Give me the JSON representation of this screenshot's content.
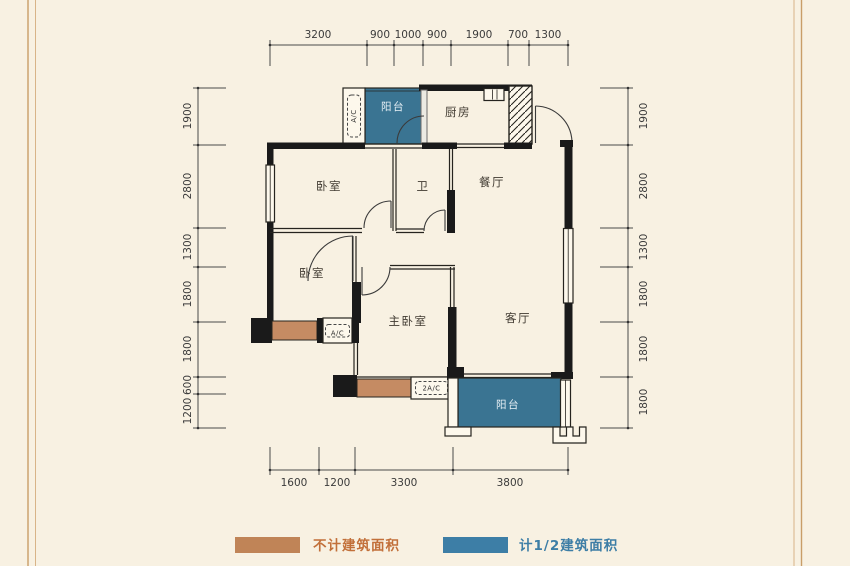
{
  "plan": {
    "room_labels": {
      "balcony_top": "阳台",
      "kitchen": "厨房",
      "bedroom_top": "卧室",
      "bathroom": "卫",
      "dining": "餐厅",
      "bedroom_mid": "卧室",
      "master_bedroom": "主卧室",
      "living": "客厅",
      "balcony_bottom": "阳台"
    },
    "ac_labels": {
      "top": "A/C",
      "mid": "A/C",
      "bottom": "2A/C"
    },
    "dimensions": {
      "top": [
        "3200",
        "900",
        "1000",
        "900",
        "1900",
        "700",
        "1300"
      ],
      "bottom": [
        "1600",
        "1200",
        "3300",
        "3800"
      ],
      "left": [
        "1900",
        "2800",
        "1300",
        "1800",
        "1800",
        "600",
        "1200"
      ],
      "right": [
        "1900",
        "2800",
        "1300",
        "1800",
        "1800",
        "1800"
      ]
    }
  },
  "legend": {
    "not_counted_label": "不计建筑面积",
    "half_counted_label": "计1/2建筑面积"
  },
  "colors": {
    "background": "#f8f1e2",
    "frame_line": "#cfa873",
    "wall": "#1a1a1a",
    "balcony_fill": "#3a7492",
    "platform_fill": "#c58b63",
    "legend_orange": "#c08457",
    "legend_orange_text": "#c2703a",
    "legend_blue": "#3d7ea6",
    "legend_blue_text": "#3d7ea6"
  }
}
